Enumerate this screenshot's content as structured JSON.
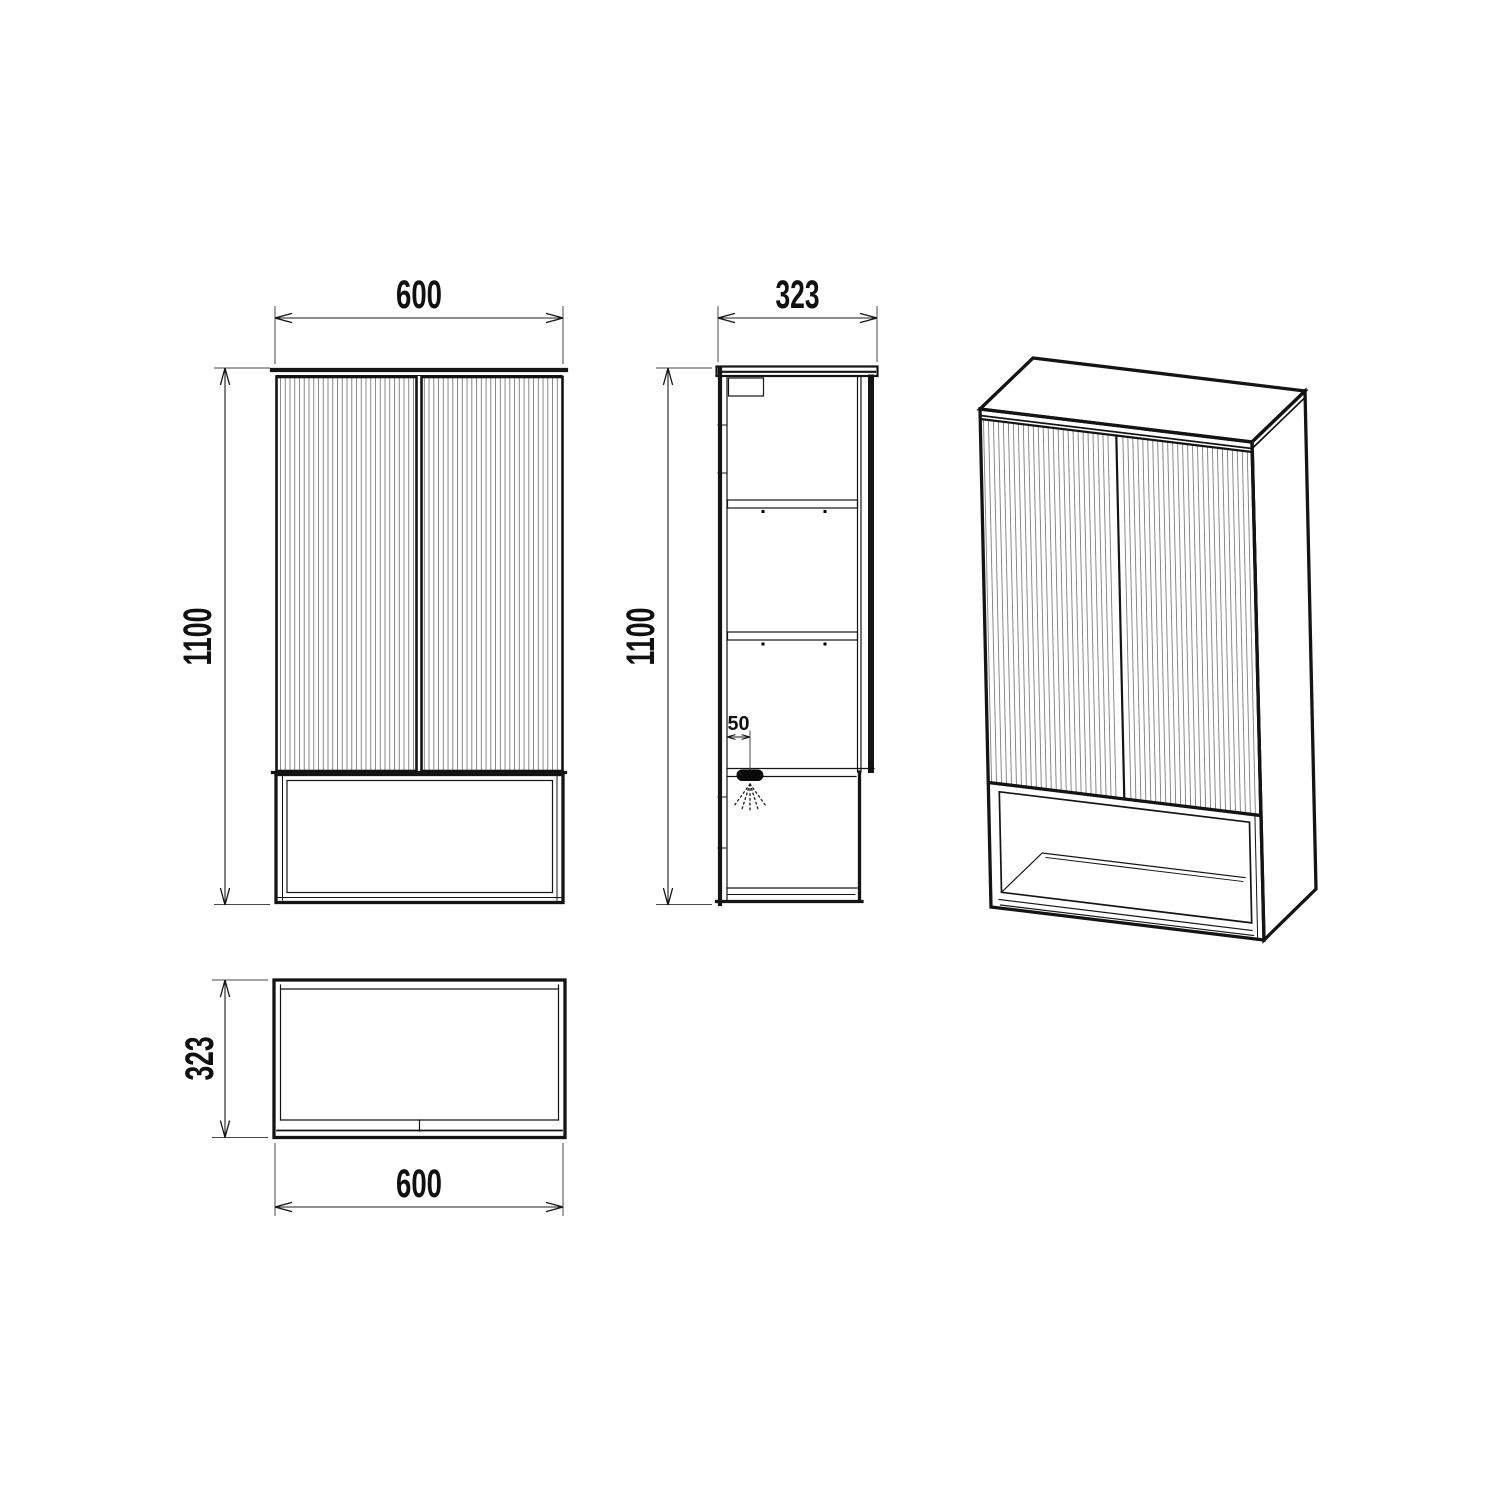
{
  "colors": {
    "background": "#ffffff",
    "line": "#141414",
    "flute": "#7d7d7d",
    "dimension_text": "#101010"
  },
  "dimensions": {
    "front": {
      "width": "600",
      "height": "1100"
    },
    "side": {
      "depth": "323",
      "height": "1100",
      "light_offset": "50"
    },
    "top": {
      "depth": "323",
      "width": "600"
    }
  }
}
